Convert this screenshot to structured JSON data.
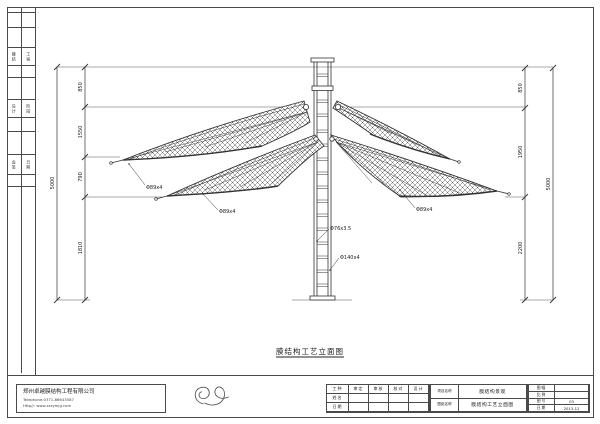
{
  "sheet": {
    "line_color": "#3a3a3a"
  },
  "side_strip": {
    "cells": [
      {
        "left": "膜结",
        "right": "工程"
      },
      {
        "left": "设计",
        "right": "阶段"
      },
      {
        "left": "会签",
        "right": "日期"
      }
    ]
  },
  "drawing": {
    "title": "膜结构工艺立面图",
    "dims_left": {
      "total": "5000",
      "segments": [
        "850",
        "1550",
        "790",
        "1810"
      ]
    },
    "dims_right": {
      "total": "5000",
      "segments": [
        "850",
        "1950",
        "2200"
      ]
    },
    "part_labels": {
      "wing_left_back": "Φ89x4",
      "wing_left_front": "Φ89x4",
      "wing_right_front": "Φ89x4",
      "ladder_rail": "Φ76x3.5",
      "mast": "Φ140x4"
    }
  },
  "footer": {
    "company": {
      "name": "郑州卓越膜结构工程有限公司",
      "phone": "Telephone:0371-86643587",
      "website": "Http//: www.zzzymjg.com"
    },
    "approval": {
      "headers": [
        "工种",
        "审定",
        "审核",
        "校对",
        "设计"
      ],
      "row_name": "姓名",
      "row_date": "日期"
    },
    "names": {
      "project_label": "项目名称",
      "project_value": "膜结构景观",
      "drawing_label": "图纸名称",
      "drawing_value": "膜结构工艺立面图"
    },
    "meta": {
      "rows": [
        {
          "label": "图幅",
          "value": ""
        },
        {
          "label": "比例",
          "value": ""
        },
        {
          "label": "图号",
          "value": "03"
        },
        {
          "label": "日期",
          "value": "2013-12"
        }
      ]
    }
  }
}
